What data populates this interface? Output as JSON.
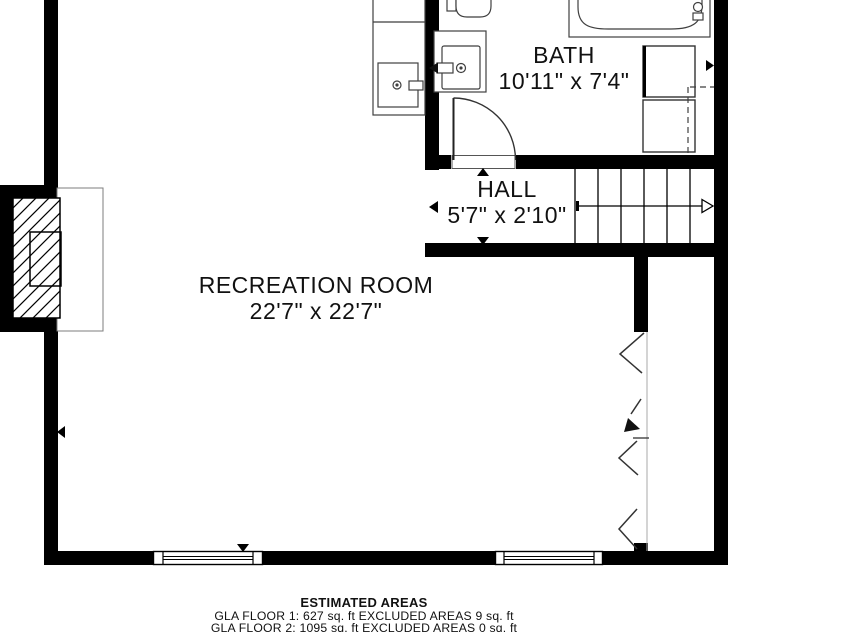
{
  "plan_title": "floor-plan-second-floor",
  "rooms": [
    {
      "name": "BATH",
      "dims": "10'11\" x 7'4\""
    },
    {
      "name": "HALL",
      "dims": "5'7\" x 2'10\""
    },
    {
      "name": "RECREATION ROOM",
      "dims": "22'7\" x 22'7\""
    }
  ],
  "fixtures": [
    "toilet",
    "vanity-sink",
    "bathtub",
    "appliance-square",
    "appliance-square",
    "wet-bar-sink",
    "fireplace",
    "hearth",
    "staircase",
    "stair-direction-arrow",
    "window",
    "window",
    "bath-door",
    "open-to-below-break-line"
  ],
  "footer": {
    "title": "ESTIMATED AREAS",
    "floor1": "GLA FLOOR 1: 627 sq. ft EXCLUDED AREAS 9 sq. ft",
    "floor2": "GLA FLOOR 2: 1095 sq. ft EXCLUDED AREAS 0 sq. ft"
  },
  "colors": {
    "wall": "#000000",
    "fixture_line": "#3f3f3f",
    "thin_line": "#9a9a9a",
    "text": "#111111",
    "background": "#ffffff"
  }
}
